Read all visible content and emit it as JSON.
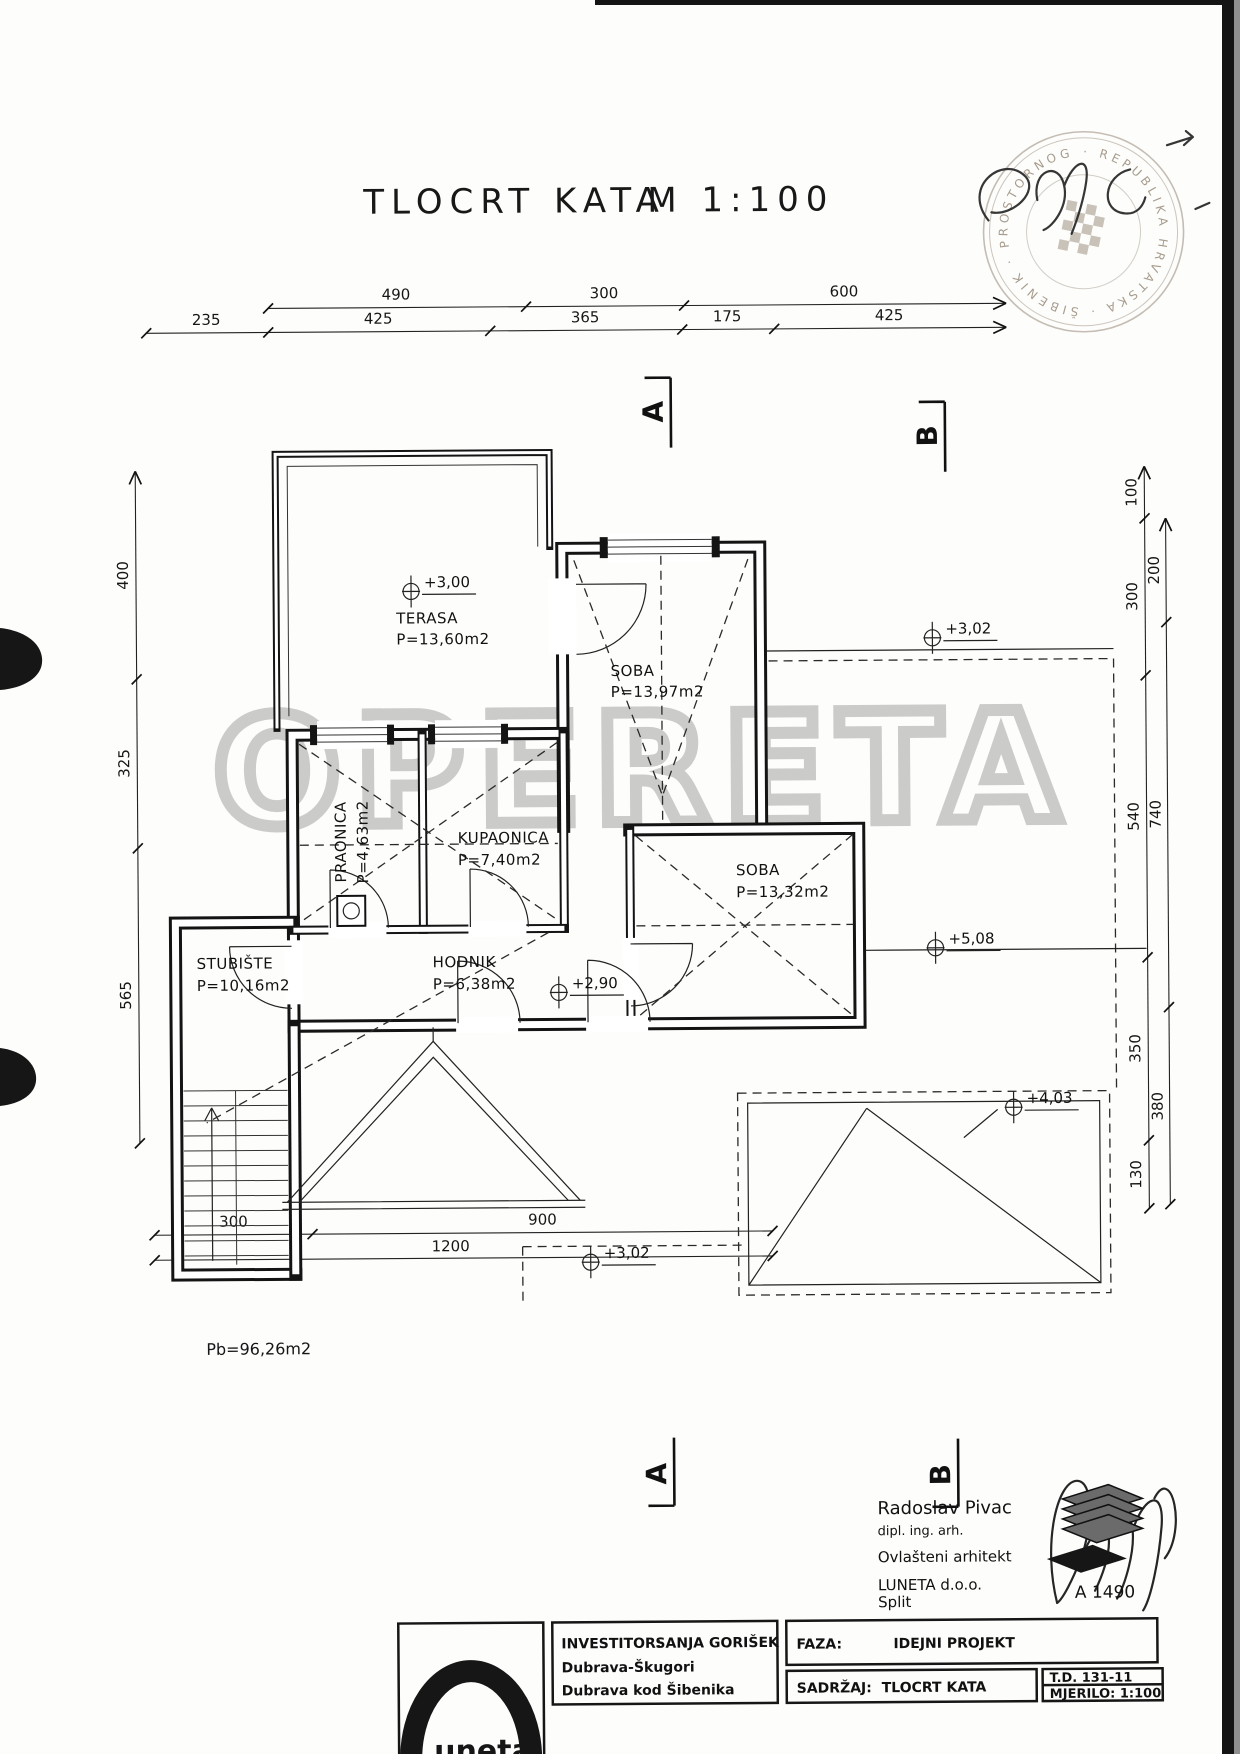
{
  "title": {
    "drawing": "TLOCRT KATA",
    "scale": "M 1:100"
  },
  "stamp": {
    "ring_text": "· REPUBLIKA HRVATSKA · ŠIBENIK · PROSTORNOG UREĐENJA ·"
  },
  "watermark": "OPERETA",
  "sections": {
    "a": "A",
    "b": "B"
  },
  "dimensions": {
    "top_row1": [
      "490",
      "300",
      "600"
    ],
    "top_row2": [
      "235",
      "425",
      "365",
      "175",
      "425"
    ],
    "left": [
      "400",
      "325",
      "565"
    ],
    "right_inner": [
      "100",
      "300",
      "540",
      "350",
      "130"
    ],
    "right_outer": [
      "200",
      "740",
      "380"
    ],
    "bottom_row1": [
      "300",
      "900"
    ],
    "bottom_row2": [
      "1200"
    ]
  },
  "rooms": [
    {
      "name": "TERASA",
      "area": "P=13,60m2"
    },
    {
      "name": "SOBA",
      "area": "P=13,97m2"
    },
    {
      "name": "PRAONICA",
      "area": "P=4,63m2"
    },
    {
      "name": "KUPAONICA",
      "area": "P=7,40m2"
    },
    {
      "name": "SOBA",
      "area": "P=13,32m2"
    },
    {
      "name": "STUBIŠTE",
      "area": "P=10,16m2"
    },
    {
      "name": "HODNIK",
      "area": "P=6,38m2"
    }
  ],
  "elevations": [
    "+3,00",
    "+3,02",
    "+2,90",
    "+5,08",
    "+4,03",
    "+3,02"
  ],
  "area_note": "Pb=96,26m2",
  "architect": {
    "name": "Radoslav Pivac",
    "title": "dipl. ing. arh.",
    "license": "Ovlašteni arhitekt",
    "company": "LUNETA d.o.o.",
    "city": "Split",
    "plan_code": "A 1490"
  },
  "title_block": {
    "investor_label": "INVESTITOR:",
    "investor": "SANJA GORIŠEK",
    "address_line1": "Dubrava-Škugori",
    "address_line2": "Dubrava kod Šibenika",
    "phase_label": "FAZA:",
    "phase": "IDEJNI PROJEKT",
    "content_label": "SADRŽAJ:",
    "content": "TLOCRT KATA",
    "td": "T.D.  131-11",
    "scale_label": "MJERILO:  1:100",
    "logo_text": "uneta"
  }
}
